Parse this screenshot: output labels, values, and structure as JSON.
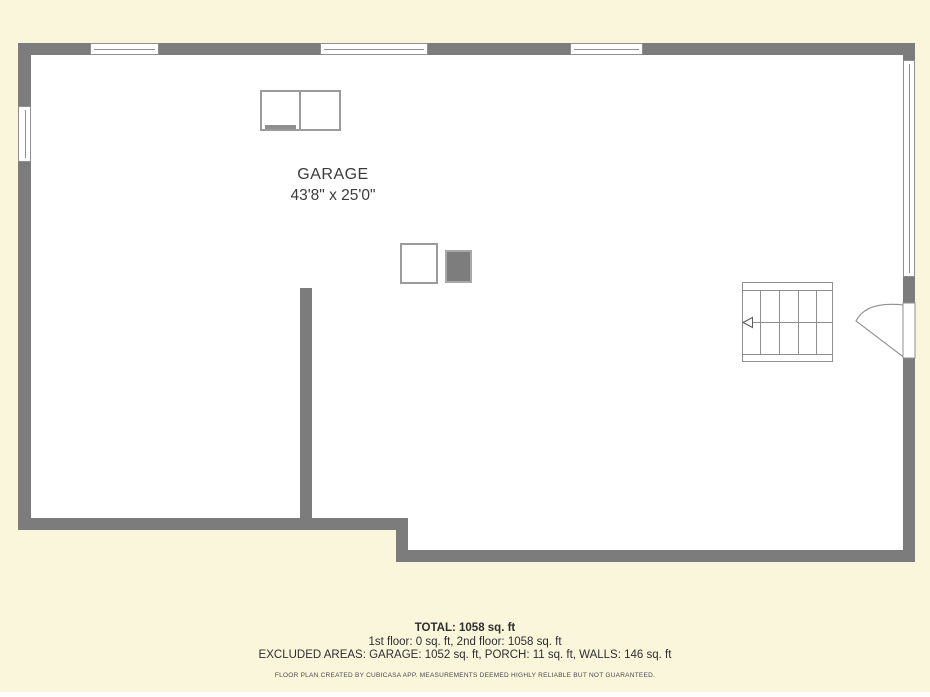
{
  "floor_plan": {
    "room": {
      "name": "GARAGE",
      "dimensions": "43'8\" x 25'0\""
    },
    "summary": {
      "total": "TOTAL: 1058 sq. ft",
      "floors": "1st floor: 0 sq. ft, 2nd floor: 1058 sq. ft",
      "excluded_areas": "EXCLUDED AREAS: GARAGE: 1052 sq. ft, PORCH: 11 sq. ft, WALLS: 146 sq. ft",
      "disclaimer": "FLOOR PLAN CREATED BY CUBICASA APP. MEASUREMENTS DEEMED HIGHLY RELIABLE BUT NOT GUARANTEED."
    },
    "colors": {
      "background": "#FAF6DC",
      "wall": "#7C7C7C",
      "room_fill": "#FFFFFF",
      "outline": "#8F8F8F",
      "fixture_solid": "#7D7D7D",
      "label_text": "#3B3B3B"
    },
    "icons": {
      "stair_direction_arrow": "left-arrow"
    }
  }
}
